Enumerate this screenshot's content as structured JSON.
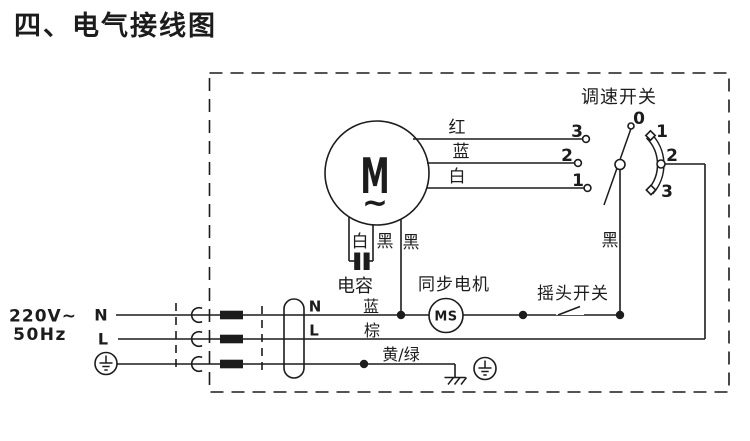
{
  "colors": {
    "ink": "#1c1c1c",
    "paper": "#ffffff"
  },
  "title": "四、电气接线图",
  "power_input": {
    "voltage": "220V~",
    "frequency": "50Hz",
    "neutral": "N",
    "live": "L"
  },
  "cord": {
    "neutral": "N",
    "live": "L",
    "wire_blue": "蓝",
    "wire_brown": "棕",
    "wire_earth": "黄/绿"
  },
  "motor": {
    "symbol": "M",
    "ac_mark": "~",
    "leads": [
      {
        "color": "红",
        "terminal": "3"
      },
      {
        "color": "蓝",
        "terminal": "2"
      },
      {
        "color": "白",
        "terminal": "1"
      }
    ],
    "bottom_leads": [
      "白",
      "黑",
      "黑"
    ],
    "capacitor_label": "电容"
  },
  "speed_switch": {
    "label": "调速开关",
    "positions": [
      "0",
      "1",
      "2",
      "3"
    ],
    "wire_black": "黑"
  },
  "sync_motor": {
    "label": "同步电机",
    "symbol": "MS"
  },
  "osc_switch": {
    "label": "摇头开关"
  }
}
